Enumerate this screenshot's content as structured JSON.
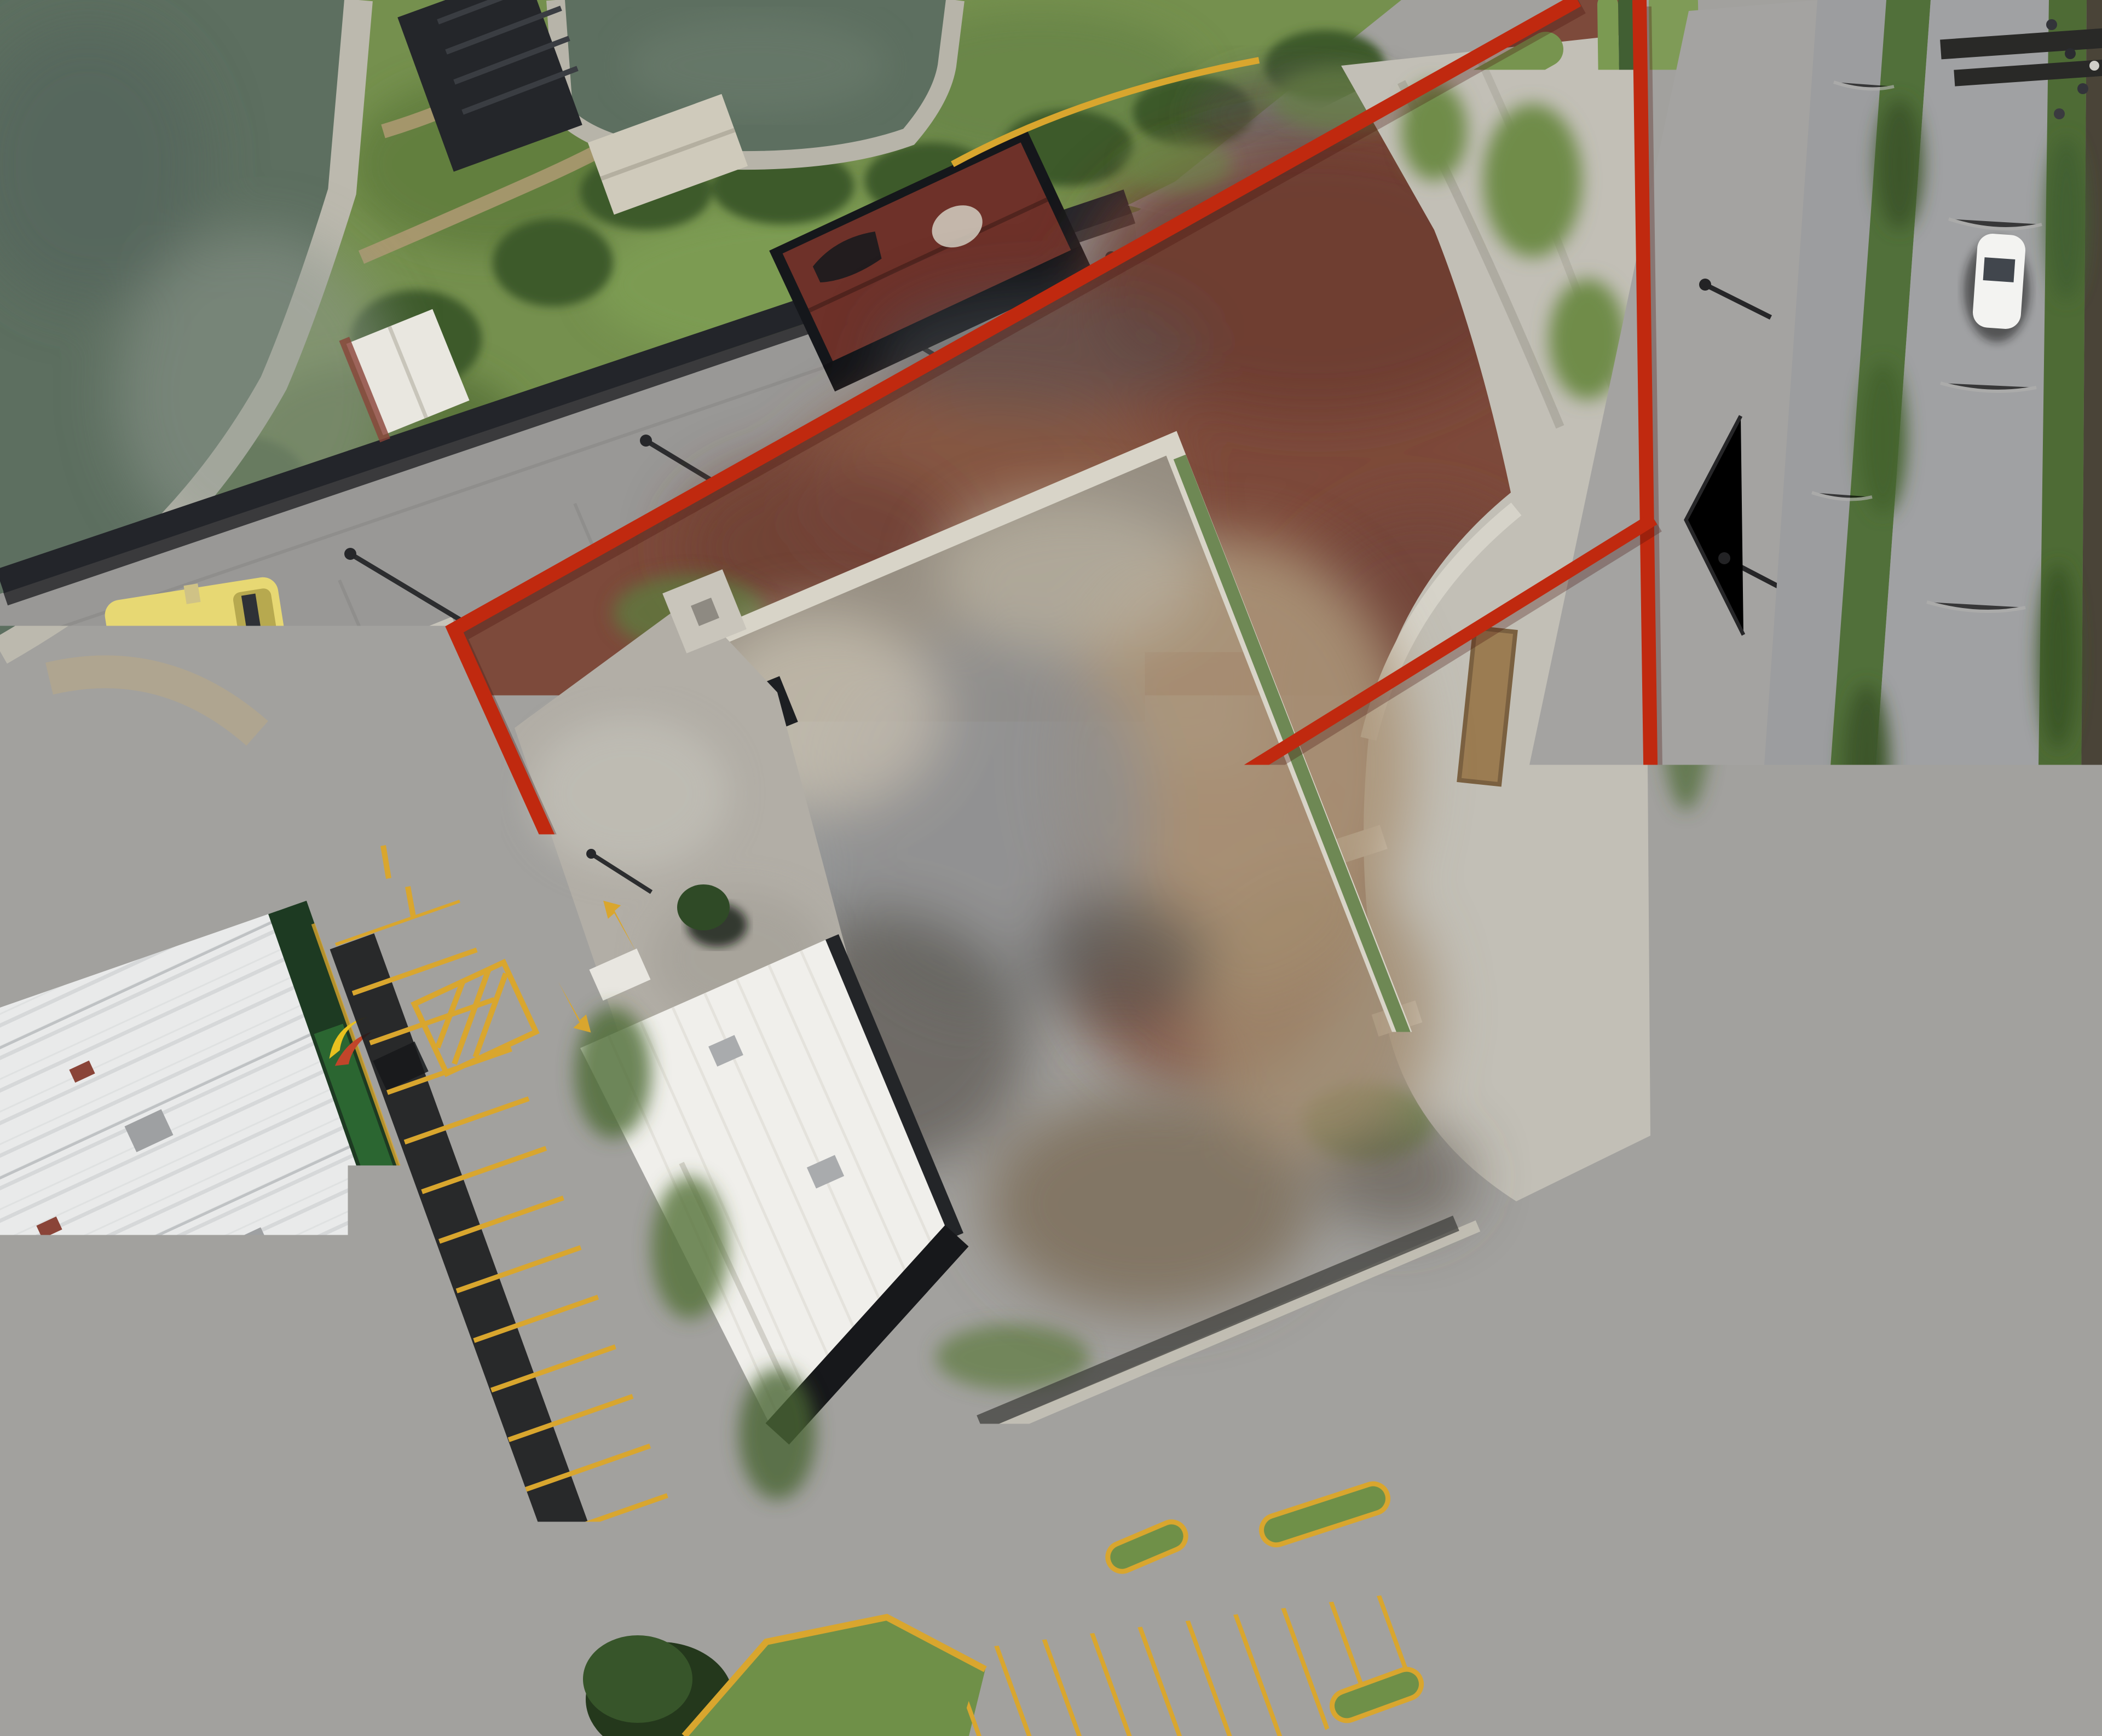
{
  "overlay": {
    "boundary_color": "#c0290f",
    "boundary_shadow": "#4a120a"
  },
  "store": {
    "banner_text": "Bodega Aurrera",
    "pickup_text": "Pickup",
    "banner_green": "#2e6b33",
    "banner_dark_green": "#1d3a22",
    "logo_yellow": "#e9c11f",
    "logo_red": "#c2452a"
  },
  "road_markings": {
    "curb_yellow": "#d9a62e"
  },
  "water": {
    "pond_color": "#5d6f60"
  }
}
